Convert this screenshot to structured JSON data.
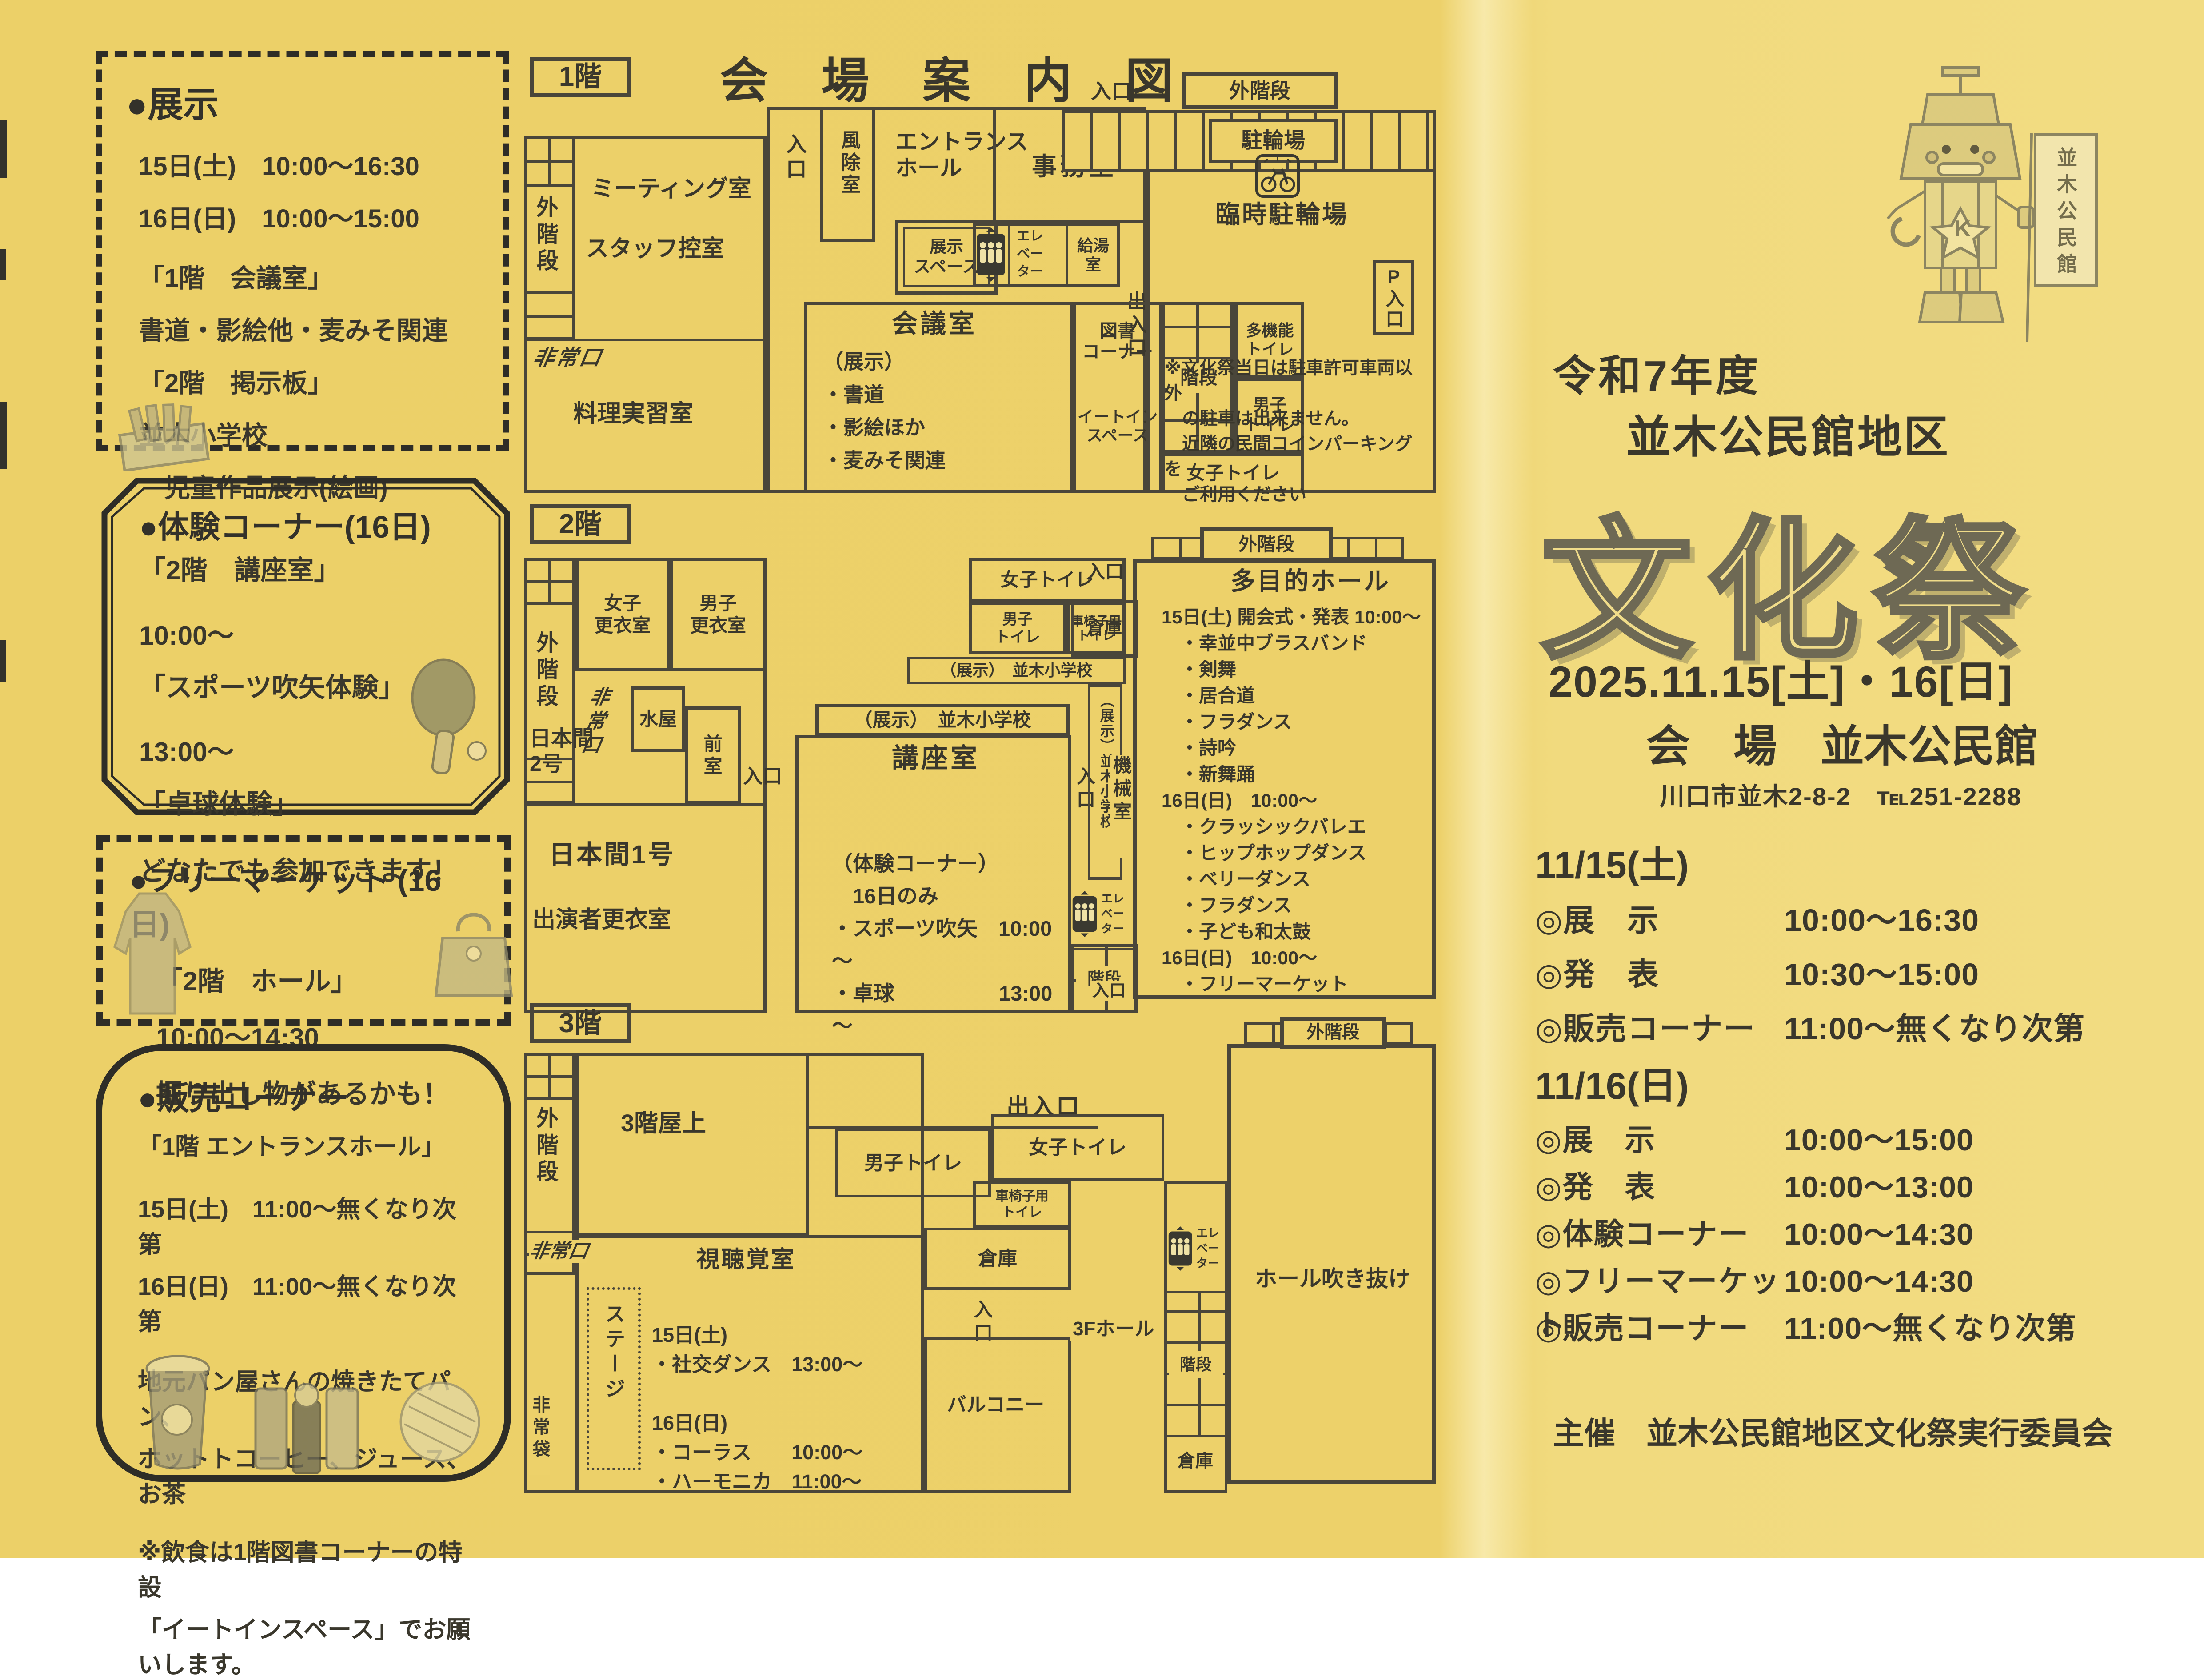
{
  "map_title": "会　場　案　内　図",
  "common": {
    "iriguchi": "入口",
    "deiriguchi": "出入口",
    "gaikaidan": "外階段",
    "soko": "倉庫",
    "kaidan": "階段",
    "hijoguchi": "非常口",
    "josi_toilet": "女子トイレ",
    "dansi_toilet": "男子トイレ",
    "dansi_toilet2": "男子\nトイレ",
    "kurumaisu_toilet": "車椅子用\nトイレ",
    "takinou_toilet": "多機能\nトイレ",
    "elevator": "エレ\nベー\nター",
    "tenji_namiki": "（展示）　並木小学校",
    "tenji_namiki_v": "（展示）並木小学校"
  },
  "left": {
    "exhibition": {
      "heading": "●展示",
      "lines": [
        "15日(土)　10:00～16:30",
        "16日(日)　10:00～15:00",
        "「1階　会議室」",
        "書道・影絵他・麦みそ関連",
        "「2階　掲示板」",
        "並木小学校",
        "　児童作品展示(絵画)"
      ]
    },
    "taiken": {
      "heading": "●体験コーナー(16日)",
      "lines": [
        "「2階　講座室」",
        "10:00～",
        "「スポーツ吹矢体験」",
        "13:00～",
        "「卓球体験」",
        "どなたでも参加できます！"
      ]
    },
    "flea": {
      "heading": "●フリーマーケット (16日)",
      "lines": [
        "「2階　ホール」",
        "10:00～14:30",
        "掘り出し物があるかも！"
      ]
    },
    "sale": {
      "heading": "●販売コーナー",
      "lines": [
        "「1階 エントランスホール」",
        "15日(土)　11:00～無くなり次第",
        "16日(日)　11:00～無くなり次第",
        "地元パン屋さんの焼きたてパン、",
        "ホットトコーヒー、ジュース、お茶",
        "※飲食は1階図書コーナーの特設",
        "「イートインスペース」でお願いします。"
      ]
    }
  },
  "floor1": {
    "label": "1階",
    "meeting": "ミーティング室",
    "staff": "スタッフ控室",
    "cooking": "料理実習室",
    "fujyoshitsu": "風除室",
    "entrance_hall": "エントランス\nホール",
    "tenji_space": "展示\nスペース",
    "jimushitsu": "事務室",
    "kyuto": "給湯\n室",
    "kaigi": "会議室",
    "kaigi_lines": [
      "（展示）",
      "・書道",
      "・影絵ほか",
      "・麦みそ関連"
    ],
    "tosho": "図書\nコーナー",
    "eatin": "イートイン\nスペース",
    "churinjo": "駐輪場",
    "rinji_churinjo": "臨時駐輪場",
    "p_iriguchi": "P入口",
    "parking_note": [
      "※文化祭当日は駐車許可車両以外",
      "　の駐車は出来ません。",
      "　近隣の民間コインパーキングを",
      "　ご利用ください"
    ]
  },
  "floor2": {
    "label": "2階",
    "josi_koui": "女子\n更衣室",
    "dansi_koui": "男子\n更衣室",
    "nihonma2": "日本間\n2号",
    "mizuya": "水屋",
    "zenshitsu": "前\n室",
    "nihonma1": "日本間1号",
    "shutsuensha": "出演者更衣室",
    "koza": "講座室",
    "taiken_lines": [
      "（体験コーナー）",
      "　16日のみ",
      "・スポーツ吹矢　10:00～",
      "・卓球　　　　　13:00～"
    ],
    "itaku": "委託\n控室",
    "kikai": "機械室",
    "hall": "多目的ホール",
    "hall_lines": [
      "15日(土) 開会式・発表 10:00～",
      "　・幸並中ブラスバンド",
      "　・剣舞",
      "　・居合道",
      "　・フラダンス",
      "　・詩吟",
      "　・新舞踊",
      "16日(日)　10:00～",
      "　・クラッシックバレエ",
      "　・ヒップホップダンス",
      "　・ベリーダンス",
      "　・フラダンス",
      "　・子ども和太鼓",
      "16日(日)　10:00～",
      "　・フリーマーケット"
    ]
  },
  "floor3": {
    "label": "3階",
    "okujo": "3階屋上",
    "shichokaku": "視聴覚室",
    "stage": "ステージ",
    "av_lines": [
      "15日(土)",
      "・社交ダンス　13:00～",
      "",
      "16日(日)",
      "・コーラス　　10:00～",
      "・ハーモニカ　11:00～"
    ],
    "balcony": "バルコニー",
    "hall3f": "3Fホール",
    "fukinuke": "ホール吹き抜け",
    "hijobukuro": "非常袋"
  },
  "right": {
    "era_line": "令和7年度",
    "district_line": "並木公民館地区",
    "festival_title": "文化祭",
    "date_line": "2025.11.15[土]・16[日]",
    "venue_line": "会　場　並木公民館",
    "address_line": "川口市並木2-8-2　℡251-2288",
    "day1": {
      "heading": "11/15(土)",
      "rows": [
        {
          "label": "◎展　示",
          "time": "10:00～16:30"
        },
        {
          "label": "◎発　表",
          "time": "10:30～15:00"
        },
        {
          "label": "◎販売コーナー",
          "time": "11:00～無くなり次第"
        }
      ]
    },
    "day2": {
      "heading": "11/16(日)",
      "rows": [
        {
          "label": "◎展　示",
          "time": "10:00～15:00"
        },
        {
          "label": "◎発　表",
          "time": "10:00～13:00"
        },
        {
          "label": "◎体験コーナー",
          "time": "10:00～14:30"
        },
        {
          "label": "◎フリーマーケット",
          "time": "10:00～14:30"
        },
        {
          "label": "◎販売コーナー",
          "time": "11:00～無くなり次第"
        }
      ]
    },
    "organizer_line": "主催　並木公民館地区文化祭実行委員会",
    "flag_text": "並木公民館",
    "mascot_letter": "K"
  },
  "icons": {
    "elevator": "elevator-people-icon",
    "bicycle": "bicycle-icon",
    "robot": "robot-mascot",
    "paddle": "table-tennis-paddle-image",
    "coat": "coat-image",
    "handbag": "handbag-image",
    "crayons": "crayon-box-image",
    "coffee": "coffee-cup-image",
    "drinks": "drink-bottles-image",
    "bread": "bread-image"
  }
}
